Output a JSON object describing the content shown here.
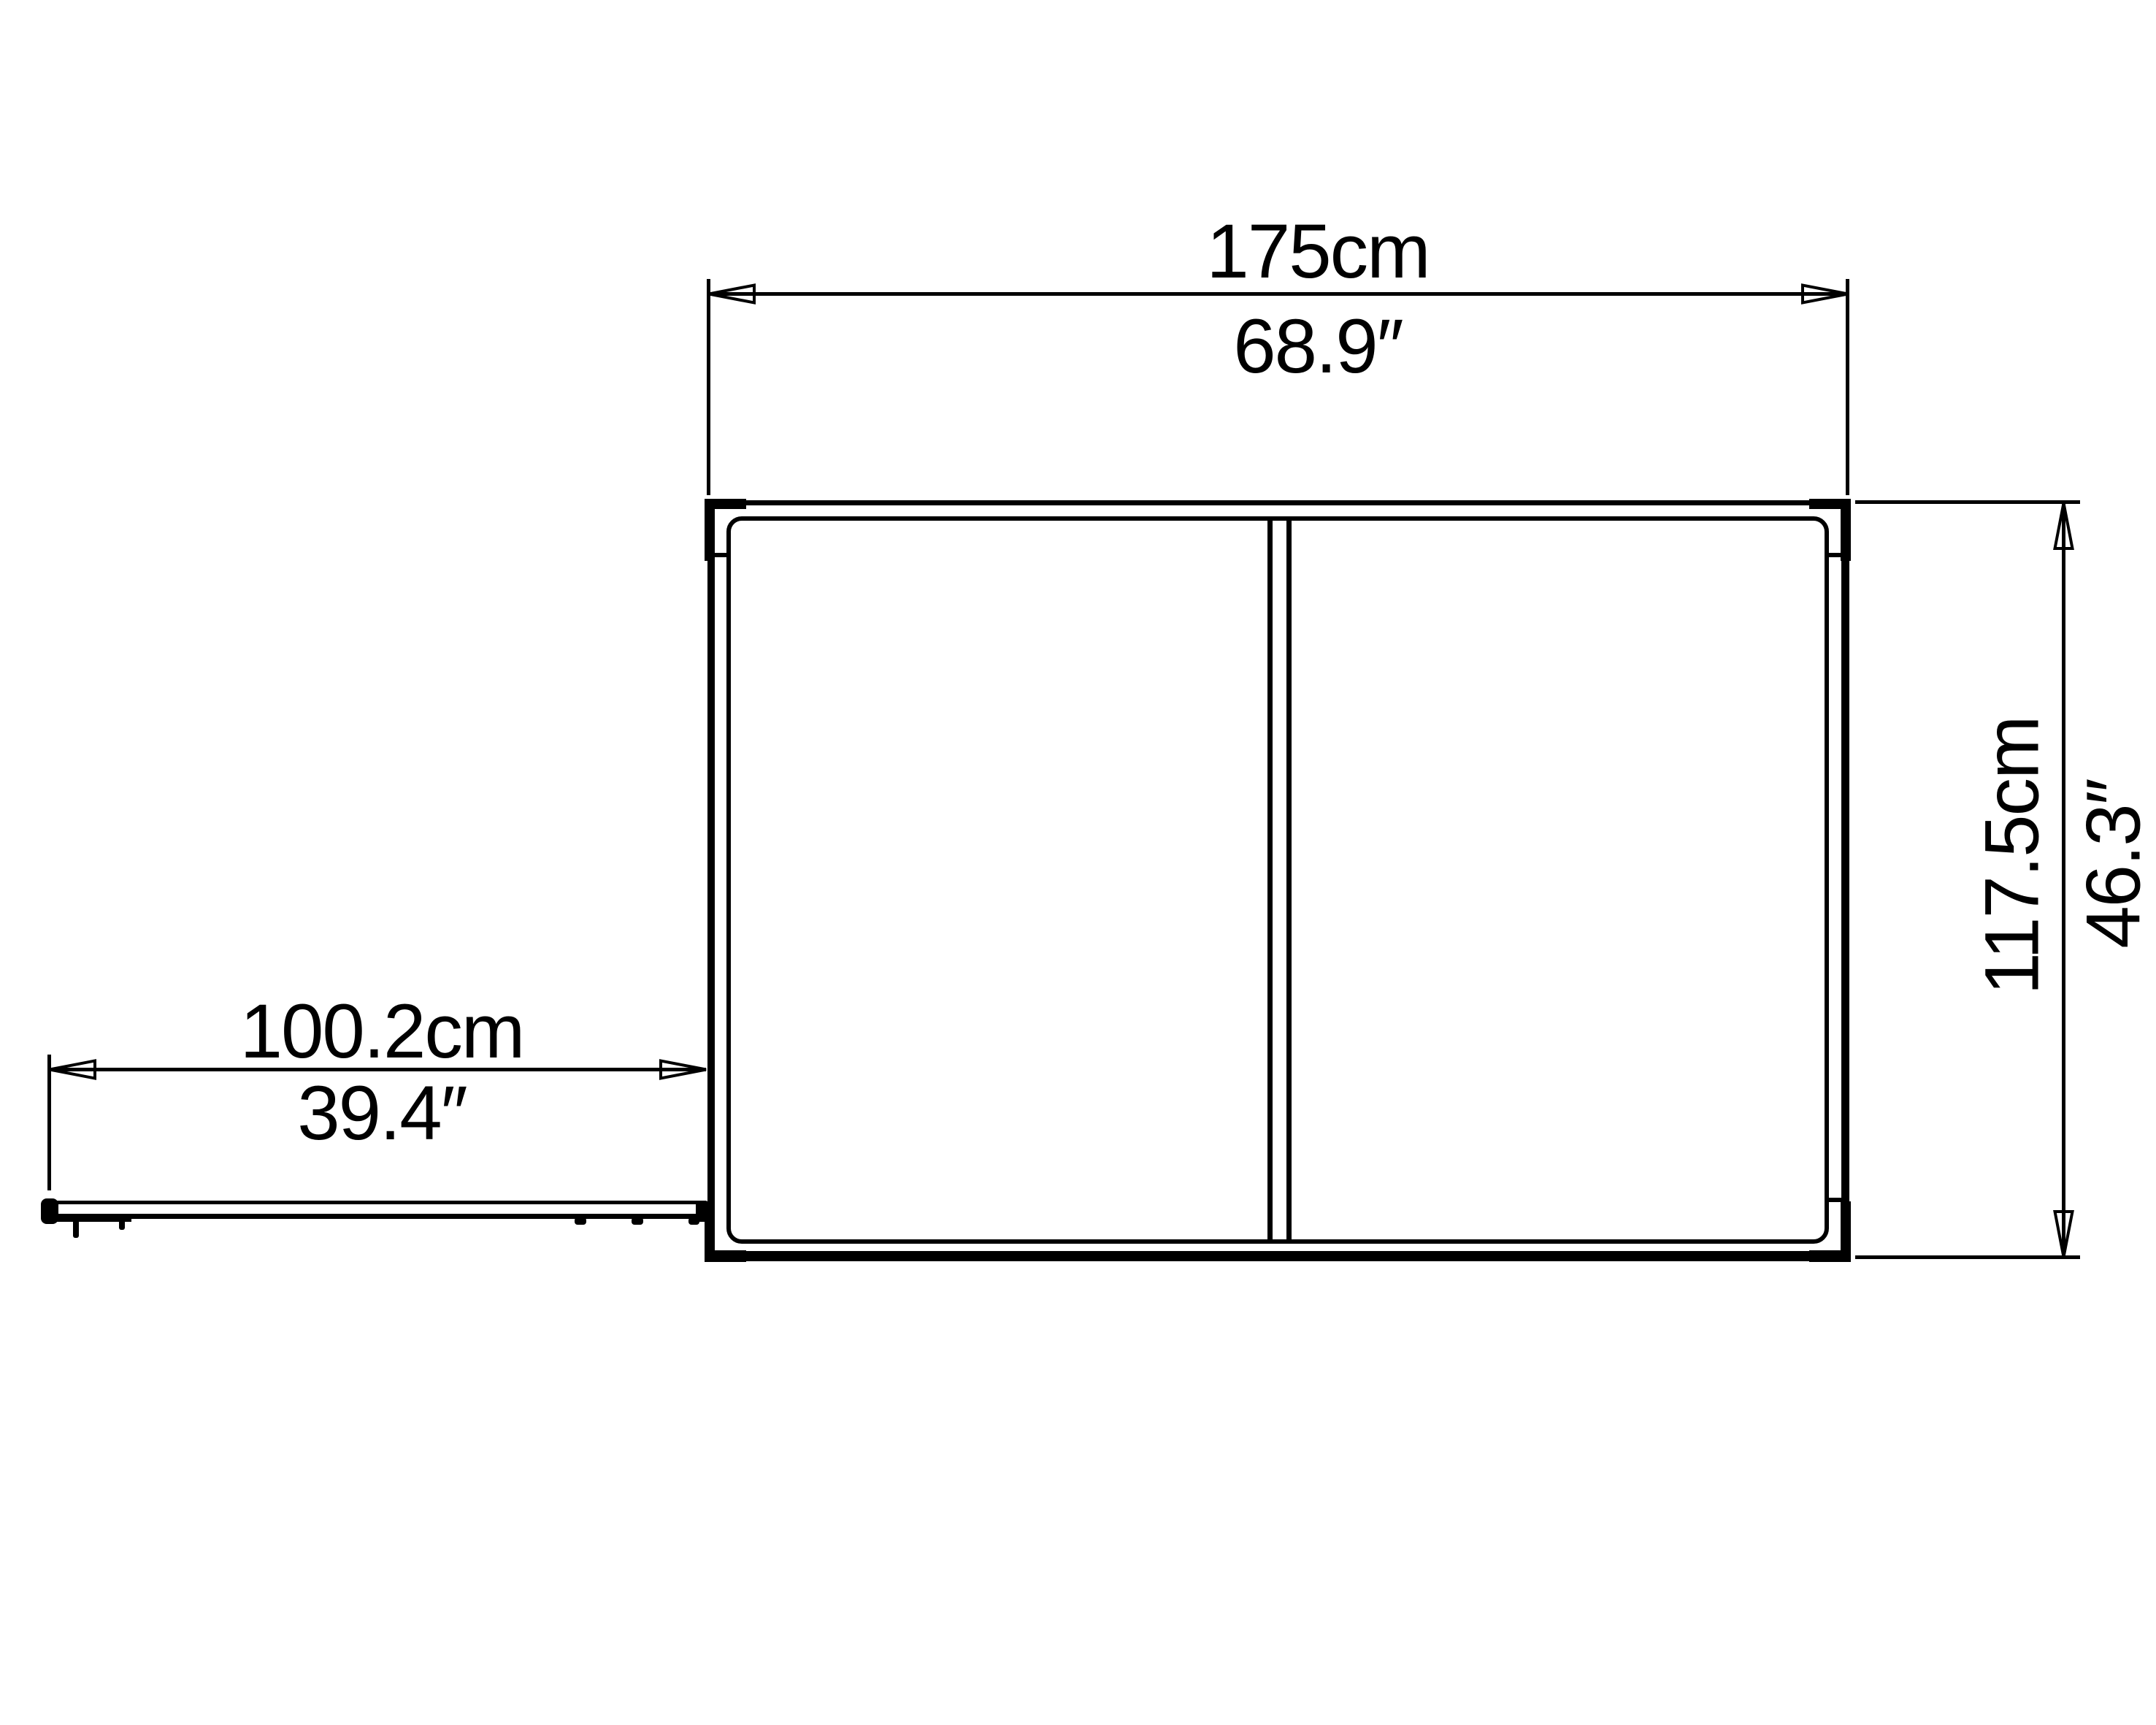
{
  "diagram": {
    "type": "top-view dimension drawing",
    "colors": {
      "line": "#000000",
      "background": "#ffffff"
    }
  },
  "dimensions": {
    "width": {
      "metric": "175cm",
      "imperial": "68.9″"
    },
    "depth": {
      "metric": "117.5cm",
      "imperial": "46.3″"
    },
    "door_opening": {
      "metric": "100.2cm",
      "imperial": "39.4″"
    }
  }
}
